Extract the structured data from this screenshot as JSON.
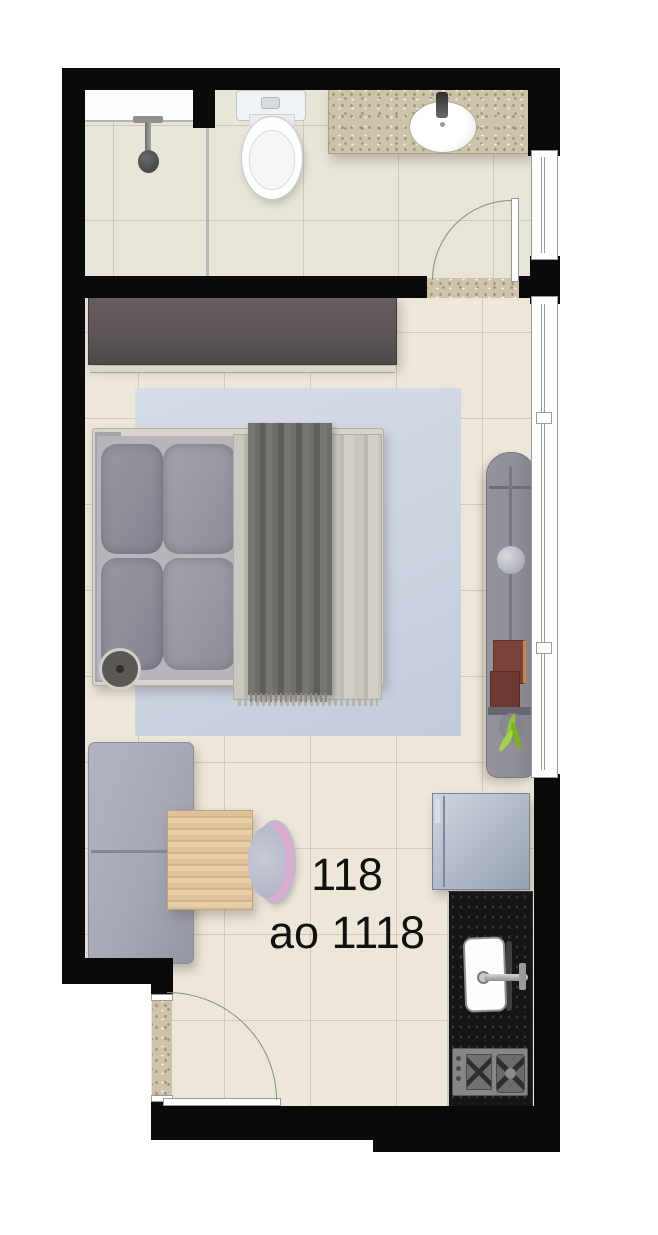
{
  "unit_label": {
    "line1": "118",
    "line2": "ao 1118"
  },
  "colors": {
    "wall": "#0a0a0a",
    "floor": "#ede7da",
    "bath-floor": "#e9e4d8",
    "granite": "#cdc3a9",
    "rug": "#cfd6e3",
    "wardrobe": "#5d5556",
    "blanket": "#c9c5bf",
    "throw": "#6f6d6a",
    "pillow": "#8f8d96",
    "sofa": "#a6a8b4",
    "wood": "#dec19a",
    "chair-accent": "#d9abce",
    "desk": "#8f8e96",
    "desk-chair": "#7b4238",
    "plant": "#93c33c",
    "fridge": "#b2bbc9",
    "counter": "#151515",
    "ink": "#111111"
  },
  "fixtures": [
    "shower",
    "shower-glass-partition",
    "toilet",
    "vanity-counter",
    "vanity-sink",
    "bathroom-door",
    "bathroom-window",
    "wardrobe",
    "double-bed",
    "pillows",
    "area-rug",
    "bedside-lamp",
    "desk-console",
    "desk-stool",
    "desk-chair",
    "potted-plant",
    "bedroom-window",
    "sofa",
    "dining-table",
    "dining-chair",
    "refrigerator",
    "kitchen-counter",
    "kitchen-sink",
    "cooktop",
    "entry-door"
  ]
}
